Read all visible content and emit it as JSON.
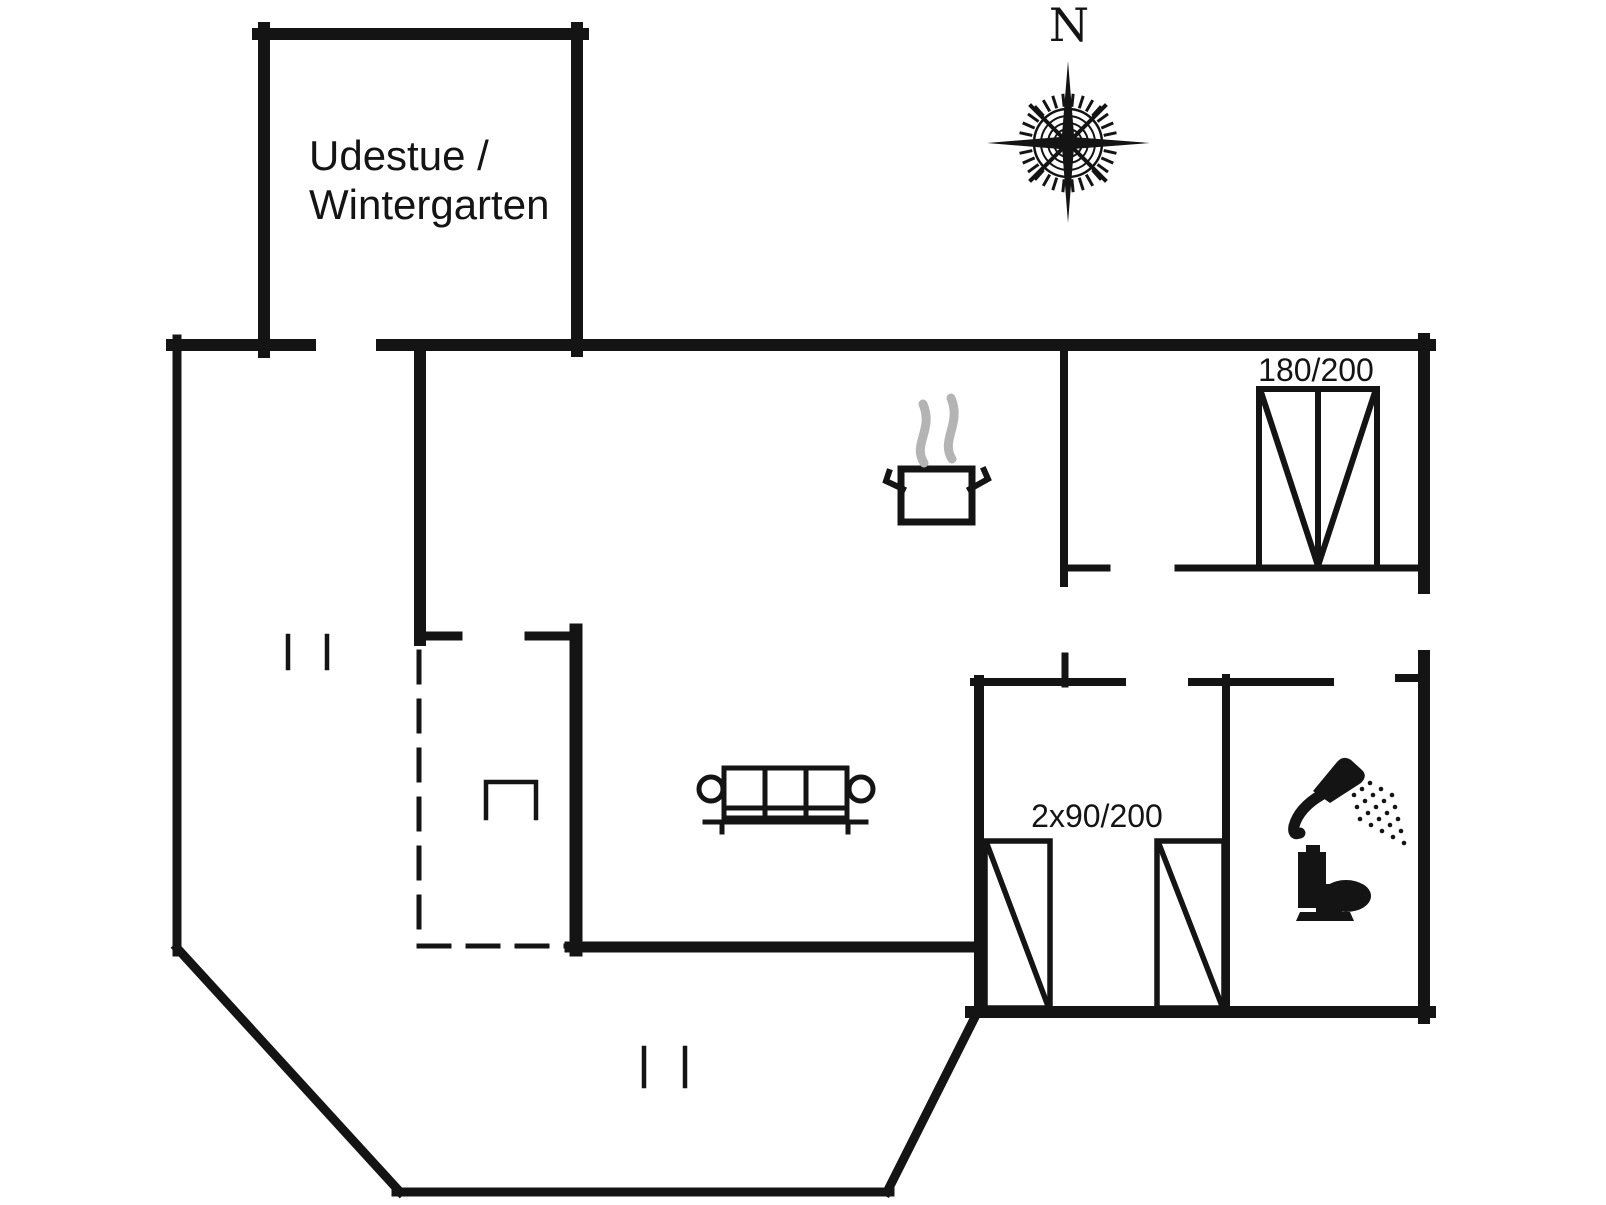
{
  "canvas": {
    "width": 1606,
    "height": 1205,
    "background": "#ffffff",
    "ink": "#141414",
    "steam": "#b4b4b4"
  },
  "labels": {
    "sunroom": {
      "line1": "Udestue /",
      "line2": "Wintergarten"
    },
    "compass_north": "N",
    "double_bed_size": "180/200",
    "single_beds_size": "2x90/200"
  },
  "icons": {
    "compass_rose": "compass-rose-icon",
    "cooking_pot": "cooking-pot-steam-icon",
    "sofa": "sofa-icon",
    "chair": "chair-icon",
    "double_bed": "double-bed-icon",
    "single_beds": "two-single-beds-icon",
    "shower": "shower-icon",
    "toilet": "toilet-icon"
  }
}
